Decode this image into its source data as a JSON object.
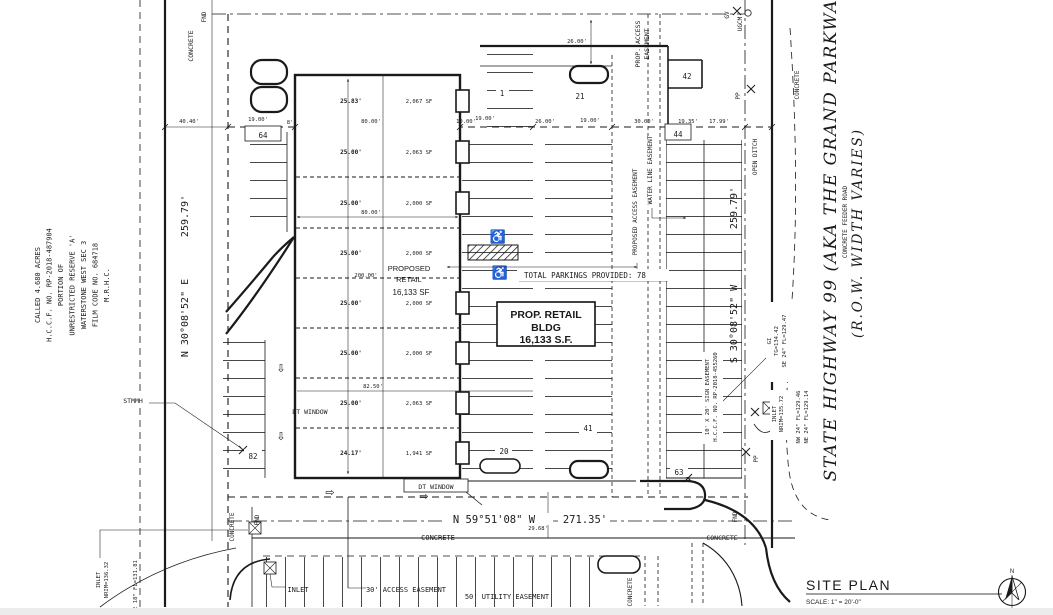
{
  "drawing": {
    "title": "SITE PLAN",
    "scale": "SCALE: 1\" = 20'-0\"",
    "north_label": "N"
  },
  "property_note": {
    "line1": "CALLED 4.680 ACRES",
    "line2": "H.C.C.F. NO. RP-2018-487904",
    "line3": "PORTION OF",
    "line4": "UNRESTRICTED RESERVE 'A'",
    "line5": "WATERSTONE WEST SEC 3",
    "line6": "FILM CODE NO. 684718",
    "line7": "M.R.H.C."
  },
  "boundary": {
    "west_bearing": "N 30°08'52\" E",
    "west_distance": "259.79'",
    "east_bearing": "S 30°08'52\" W",
    "east_distance": "259.79'",
    "south_bearing": "N 59°51'08\" W",
    "south_distance": "271.35'"
  },
  "highway": {
    "name": "STATE HIGHWAY 99 (AKA THE GRAND PARKWAY)",
    "row_note": "(R.O.W. WIDTH VARIES)",
    "feeder": "CONCRETE FEEDER ROAD",
    "open_ditch": "OPEN DITCH"
  },
  "building": {
    "box_line1": "PROP. RETAIL",
    "box_line2": "BLDG",
    "box_line3": "16,133 S.F.",
    "center_line1": "PROPOSED",
    "center_line2": "RETAIL",
    "center_line3": "16,133 SF",
    "bays": [
      {
        "dim": "25.83'",
        "area": "2,067 SF"
      },
      {
        "dim": "25.00'",
        "area": "2,063 SF"
      },
      {
        "dim": "25.00'",
        "area": "2,000 SF"
      },
      {
        "dim": "25.00'",
        "area": "2,000 SF"
      },
      {
        "dim": "25.00'",
        "area": "2,000 SF"
      },
      {
        "dim": "25.00'",
        "area": "2,000 SF"
      },
      {
        "dim": "25.00'",
        "area": "2,063 SF"
      },
      {
        "dim": "24.17'",
        "area": "1,941 SF"
      }
    ],
    "width_dim_mid": "80.00'",
    "width_dim_low": "82.50'",
    "depth_dim": "200.00'",
    "dt_window_side": "DT WINDOW",
    "dt_window_rear": "DT WINDOW"
  },
  "parking": {
    "total_note": "TOTAL PARKINGS PROVIDED: 78",
    "count_1": "1",
    "count_20": "20",
    "count_21": "21",
    "count_41": "41",
    "count_42": "42",
    "count_44": "44",
    "count_63": "63",
    "count_64": "64",
    "count_82": "82"
  },
  "dimensions": {
    "d_40_40": "40.40'",
    "d_19a": "19.00'",
    "d_8": "8'",
    "d_80": "80.00'",
    "d_10": "10.00'",
    "d_19b": "19.00'",
    "d_26a": "26.00'",
    "d_19c": "19.00'",
    "d_30": "30.00'",
    "d_19_35": "19.35'",
    "d_17_99": "17.99'",
    "d_26v": "26.00'",
    "d_29_68": "29.68'"
  },
  "easements": {
    "prop_access_l1": "PROP. ACCESS",
    "prop_access_l2": "EASEMENT",
    "proposed_access": "PROPOSED ACCESS EASEMENT",
    "water_line": "WATER LINE EASEMENT",
    "sign_l1": "10' X 20' SIGN EASEMENT",
    "sign_l2": "H.C.C.F. NO. RP-2018-455260",
    "access_30": "30' ACCESS EASEMENT",
    "utility_50": "50' UTILITY EASEMENT"
  },
  "utilities": {
    "stmmh": "STMMH",
    "inlet_sw_l1": "INLET",
    "inlet_sw_l2": "NRIM=136.32",
    "inlet_sw_l3": "E 18\" FL=131.81",
    "inlet_s": "INLET",
    "inlet_e_l1": "INLET",
    "inlet_e_l2": "NRIM=135.72",
    "inlet_e_l3": "NW 24\" FL=129.46",
    "inlet_e_l4": "NE 24\" FL=129.14",
    "gi_l1": "GI",
    "gi_l2": "TG=134.42",
    "gi_l3": "SE 24\" FL=129.47",
    "gv": "GV",
    "ugcm": "UGCM",
    "pp_top": "PP",
    "pp_bottom": "PP"
  },
  "surface_labels": {
    "concrete_nw": "CONCRETE",
    "fnd_nw": "FND",
    "concrete_sw": "CONCRETE",
    "fnd_sw": "FND",
    "concrete_s": "CONCRETE",
    "concrete_se": "CONCRETE",
    "fnd_se": "FND",
    "concrete_e": "CONCRETE",
    "concrete_s2": "CONCRETE"
  }
}
